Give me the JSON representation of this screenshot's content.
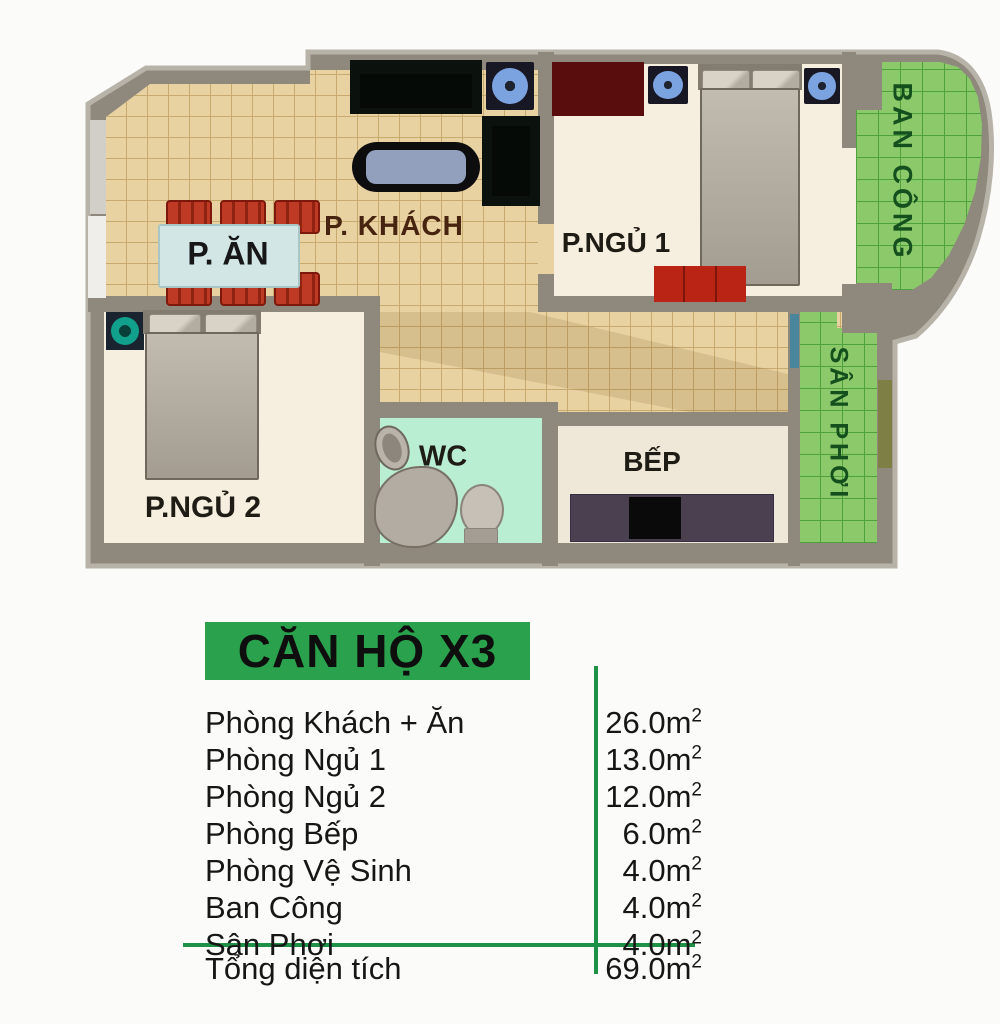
{
  "page": {
    "background": "#fbfbf9"
  },
  "plan": {
    "labels": {
      "living": "P. KHÁCH",
      "dining": "P. ĂN",
      "bedroom1": "P.NGỦ 1",
      "bedroom2": "P.NGỦ 2",
      "wc": "WC",
      "kitchen": "BẾP",
      "balcony": "BAN CÔNG",
      "laundry": "SÂN PHƠI"
    },
    "colors": {
      "wall": "#8f897d",
      "wall_light": "#b8b3a9",
      "floor_tile": "#e9d2a2",
      "floor_grid": "#c9aa6e",
      "room_floor": "#f6efdf",
      "kitchen_floor": "#efe8d8",
      "wc_floor": "#b9eed3",
      "green_floor": "#8cc96a",
      "green_grid": "#4ea23e",
      "green_text": "#14501e",
      "label_text": "#1f1b15",
      "living_text": "#46240f"
    }
  },
  "legend": {
    "title": "CĂN HỘ X3",
    "title_bg": "#2aa24d",
    "line_color": "#1d9146",
    "unit": "m",
    "sup": "2",
    "rows": [
      {
        "label": "Phòng Khách + Ăn",
        "area": "26.0"
      },
      {
        "label": "Phòng Ngủ 1",
        "area": "13.0"
      },
      {
        "label": "Phòng Ngủ 2",
        "area": "12.0"
      },
      {
        "label": "Phòng Bếp",
        "area": "6.0"
      },
      {
        "label": "Phòng Vệ Sinh",
        "area": "4.0"
      },
      {
        "label": "Ban Công",
        "area": "4.0"
      },
      {
        "label": "Sân Phơi",
        "area": "4.0"
      }
    ],
    "total": {
      "label": "Tổng diện tích",
      "area": "69.0"
    }
  }
}
